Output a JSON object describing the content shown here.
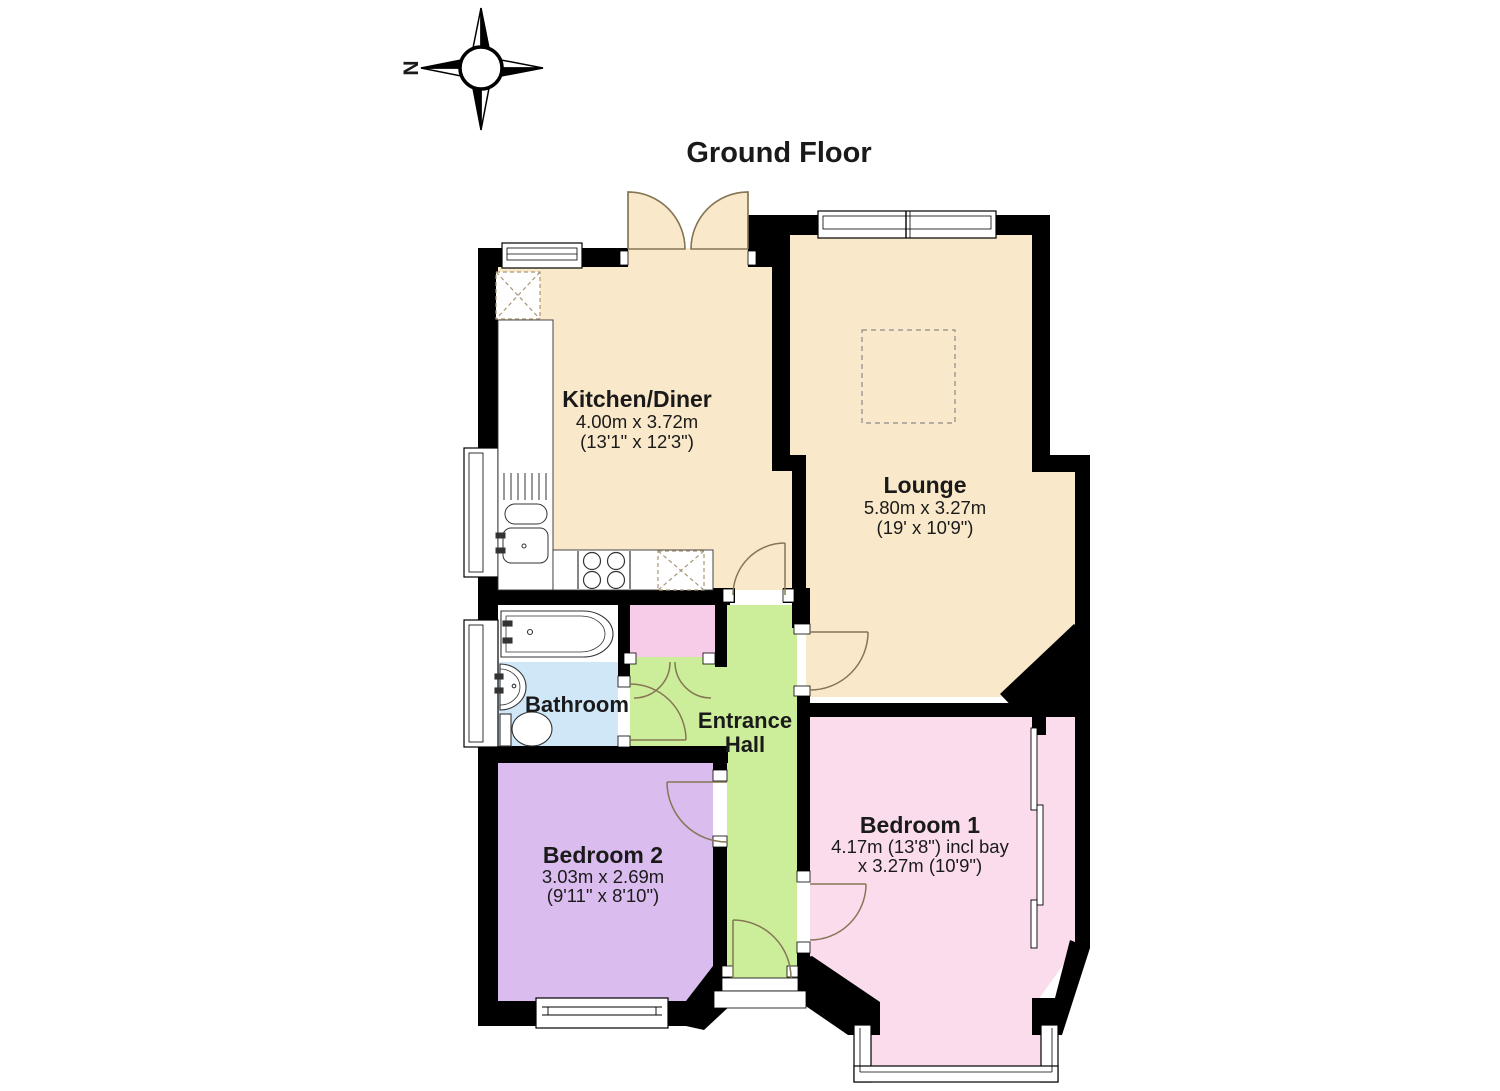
{
  "page": {
    "title": "Ground Floor"
  },
  "compass": {
    "north_label": "N"
  },
  "rooms": {
    "kitchen": {
      "name": "Kitchen/Diner",
      "dimensions_metric": "4.00m x 3.72m",
      "dimensions_imperial": "(13'1\" x 12'3\")",
      "color": "#F9E8C9"
    },
    "lounge": {
      "name": "Lounge",
      "dimensions_metric": "5.80m x 3.27m",
      "dimensions_imperial": "(19' x 10'9\")",
      "color": "#F9E8C9"
    },
    "bathroom": {
      "name": "Bathroom",
      "color": "#CFE7F7"
    },
    "entrance_hall": {
      "name": "Entrance Hall",
      "name_line1": "Entrance",
      "name_line2": "Hall",
      "color": "#CCEE9B"
    },
    "bedroom1": {
      "name": "Bedroom 1",
      "dimensions_line1": "4.17m (13'8\") incl bay",
      "dimensions_line2": "x 3.27m (10'9\")",
      "color": "#FADCEC"
    },
    "bedroom2": {
      "name": "Bedroom 2",
      "dimensions_metric": "3.03m x 2.69m",
      "dimensions_imperial": "(9'11\" x 8'10\")",
      "color": "#DABCEF"
    },
    "cupboard": {
      "color": "#F6CCE9"
    }
  },
  "colors": {
    "walls": "#000000",
    "door_arc": "#857655",
    "dashed_outline": "#8a8a8a",
    "appliance_dash": "#a89878"
  }
}
